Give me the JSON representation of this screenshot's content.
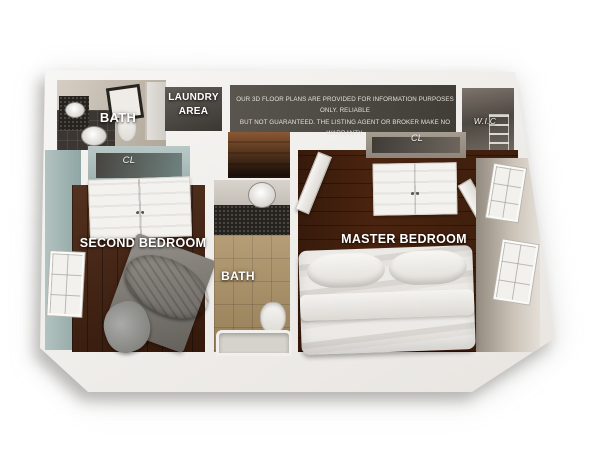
{
  "floor_plan": {
    "disclaimer": {
      "line1": "OUR 3D FLOOR PLANS ARE PROVIDED FOR INFORMATION PURPOSES ONLY. RELIABLE",
      "line2": "BUT NOT GUARANTEED. THE LISTING AGENT OR BROKER MAKE NO WARRANTY."
    },
    "rooms": {
      "bath_upper": {
        "label": "BATH"
      },
      "laundry": {
        "label_line1": "LAUNDRY",
        "label_line2": "AREA"
      },
      "closet_second": {
        "label": "CL"
      },
      "second_bedroom": {
        "label": "SECOND BEDROOM"
      },
      "bath_center": {
        "label": "BATH"
      },
      "master_bedroom": {
        "label": "MASTER BEDROOM"
      },
      "closet_master": {
        "label": "CL"
      },
      "walk_in_closet": {
        "label": "W.I.C"
      }
    },
    "colors": {
      "background": "#ffffff",
      "wall_white": "#f3f1ee",
      "teal_wall": "#9db1af",
      "wood_floor_dark": "#47220f",
      "tile_floor": "#ab9064",
      "granite": "#26221e",
      "hall_dark": "#4c4841",
      "label_text": "#ffffff"
    }
  }
}
